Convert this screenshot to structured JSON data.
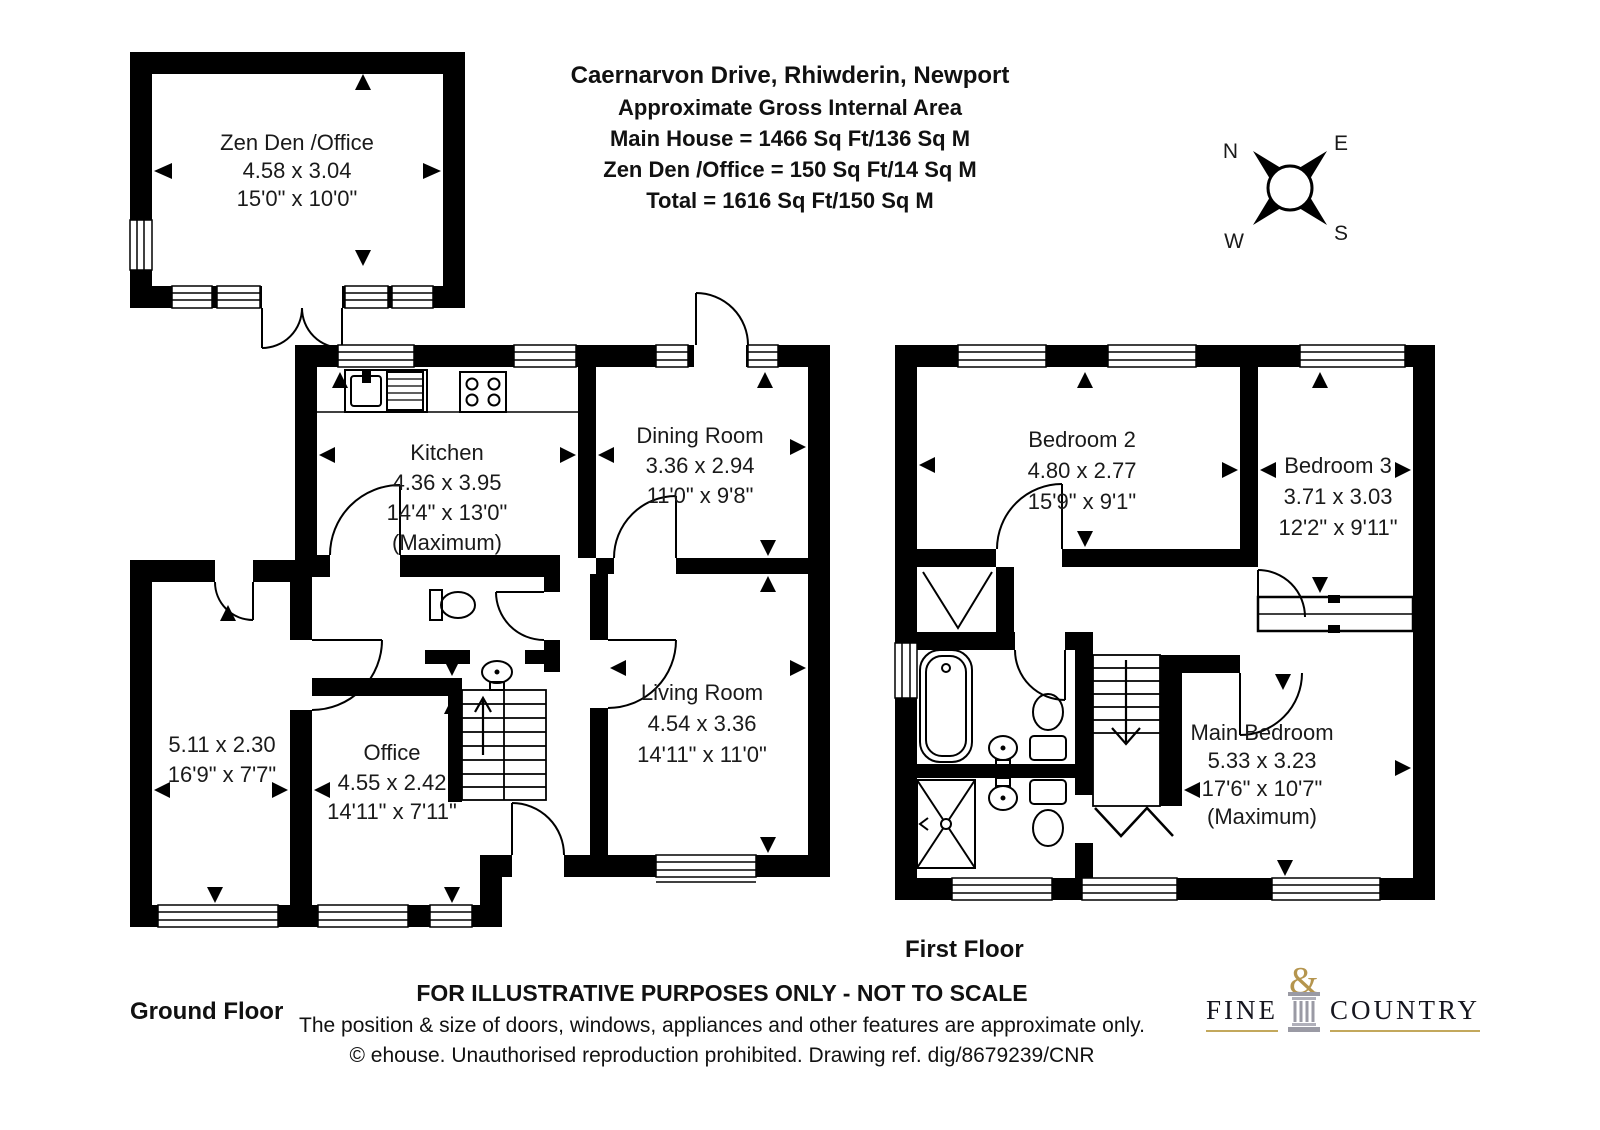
{
  "title": {
    "address": "Caernarvon Drive, Rhiwderin, Newport",
    "subtitle": "Approximate Gross Internal Area",
    "main_house": "Main House = 1466 Sq Ft/136 Sq M",
    "zen_den": "Zen Den /Office = 150 Sq Ft/14 Sq M",
    "total": "Total = 1616 Sq Ft/150 Sq M"
  },
  "compass": {
    "north": "N",
    "east": "E",
    "south": "S",
    "west": "W"
  },
  "floors": {
    "ground_label": "Ground Floor",
    "first_label": "First Floor"
  },
  "rooms": {
    "zen_den": {
      "name": "Zen Den /Office",
      "metric": "4.58 x 3.04",
      "imperial": "15'0\" x 10'0\""
    },
    "kitchen": {
      "name": "Kitchen",
      "metric": "4.36 x 3.95",
      "imperial": "14'4\" x 13'0\"",
      "note": "(Maximum)"
    },
    "dining_room": {
      "name": "Dining Room",
      "metric": "3.36 x 2.94",
      "imperial": "11'0\" x 9'8\""
    },
    "living_room": {
      "name": "Living Room",
      "metric": "4.54 x 3.36",
      "imperial": "14'11\" x 11'0\""
    },
    "office": {
      "name": "Office",
      "metric": "4.55 x 2.42",
      "imperial": "14'11\" x 7'11\""
    },
    "store": {
      "metric": "5.11 x 2.30",
      "imperial": "16'9\" x 7'7\""
    },
    "bedroom2": {
      "name": "Bedroom 2",
      "metric": "4.80 x 2.77",
      "imperial": "15'9\" x 9'1\""
    },
    "bedroom3": {
      "name": "Bedroom 3",
      "metric": "3.71 x 3.03",
      "imperial": "12'2\" x 9'11\""
    },
    "main_bedroom": {
      "name": "Main Bedroom",
      "metric": "5.33 x 3.23",
      "imperial": "17'6\" x 10'7\"",
      "note": "(Maximum)"
    }
  },
  "footer": {
    "disclaimer": "FOR ILLUSTRATIVE PURPOSES ONLY - NOT TO SCALE",
    "approx_note": "The position & size of doors, windows, appliances and other features are approximate only.",
    "copyright": "© ehouse. Unauthorised reproduction prohibited. Drawing ref. dig/8679239/CNR"
  },
  "logo": {
    "word1": "FINE",
    "amp": "&",
    "word2": "COUNTRY"
  },
  "colors": {
    "wall": "#000000",
    "gold": "#c3a85c",
    "text": "#1a1a1a"
  }
}
